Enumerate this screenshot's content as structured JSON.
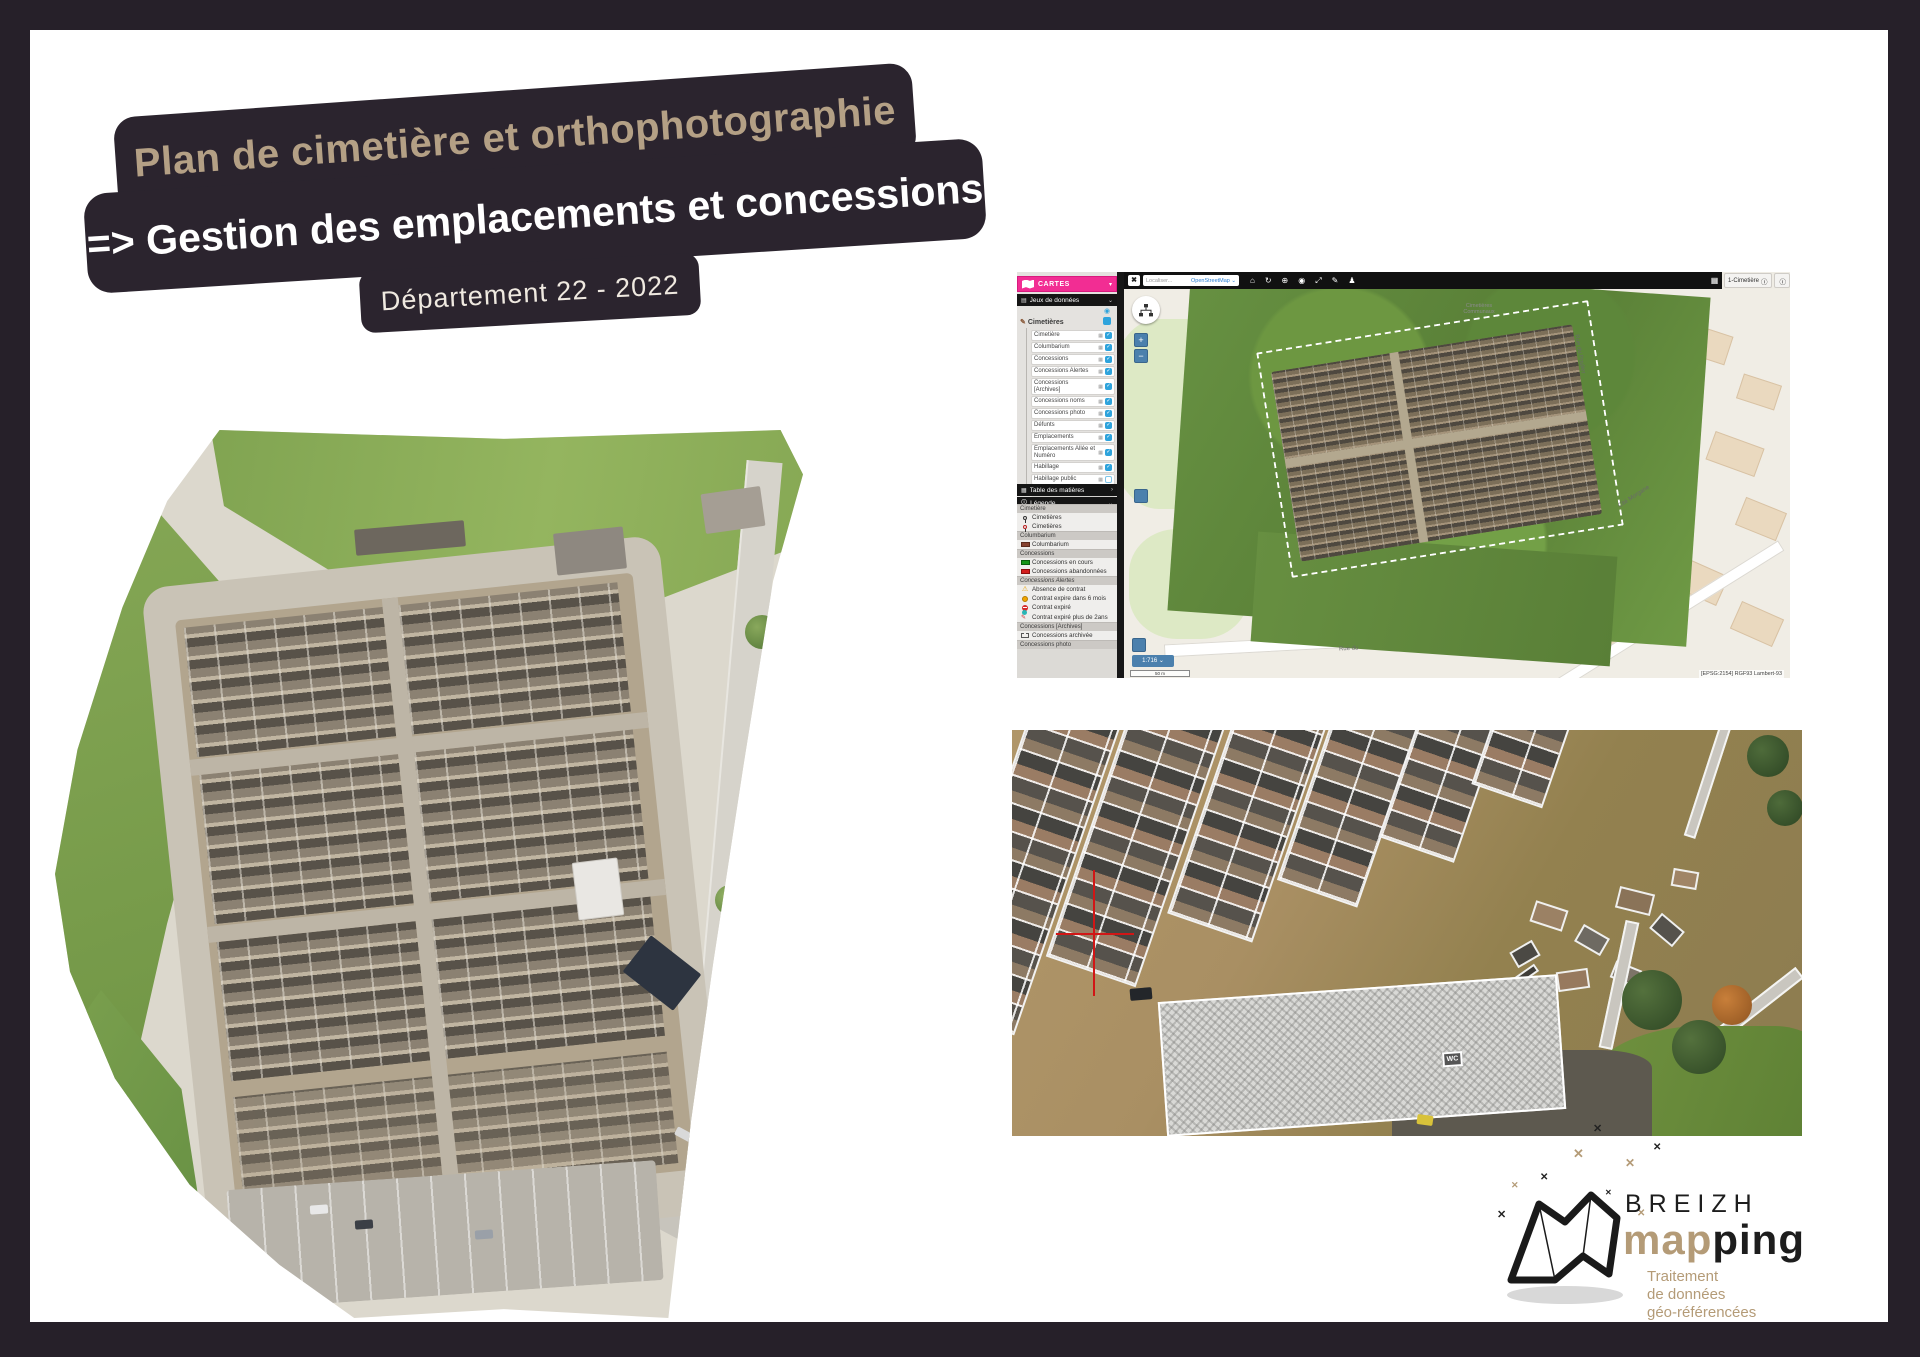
{
  "banner": {
    "line1": "Plan de cimetière et orthophotographie",
    "line2": "=> Gestion des emplacements et concessions",
    "line3": "Département 22 - 2022"
  },
  "gis": {
    "panel_title": "CARTES",
    "datasets_bar": "Jeux de données",
    "group": "Cimetières",
    "layers": [
      {
        "label": "Cimetière",
        "checked": true
      },
      {
        "label": "Columbarium",
        "checked": true
      },
      {
        "label": "Concessions",
        "checked": true
      },
      {
        "label": "Concessions Alertes",
        "checked": true
      },
      {
        "label": "Concessions [Archives]",
        "checked": true
      },
      {
        "label": "Concessions noms",
        "checked": true
      },
      {
        "label": "Concessions photo",
        "checked": true
      },
      {
        "label": "Défunts",
        "checked": true
      },
      {
        "label": "Emplacements",
        "checked": true
      },
      {
        "label": "Emplacements Allée et Numéro",
        "checked": true
      },
      {
        "label": "Habillage",
        "checked": true
      },
      {
        "label": "Habillage public",
        "checked": false
      },
      {
        "label": "Vue aérienne - Drone",
        "checked": true
      }
    ],
    "toc_bar": "Table des matières",
    "legend_bar": "Légende",
    "legend": [
      {
        "section": "Cimetière",
        "italic": false,
        "items": [
          {
            "icon": "pin-dark",
            "label": "Cimetières"
          },
          {
            "icon": "pin-red",
            "label": "Cimetières"
          }
        ]
      },
      {
        "section": "Columbarium",
        "italic": false,
        "items": [
          {
            "icon": "swatch-maroon",
            "label": "Columbarium"
          }
        ]
      },
      {
        "section": "Concessions",
        "italic": false,
        "items": [
          {
            "icon": "swatch-green",
            "label": "Concessions en cours"
          },
          {
            "icon": "swatch-red",
            "label": "Concessions abandonnées"
          }
        ]
      },
      {
        "section": "Concessions Alertes",
        "italic": true,
        "items": [
          {
            "icon": "warning-triangle",
            "label": "Absence de contrat"
          },
          {
            "icon": "orange-circle",
            "label": "Contrat expire dans 6 mois"
          },
          {
            "icon": "stop-sign",
            "label": "Contrat expiré"
          },
          {
            "icon": "teal-pen",
            "label": "Contrat expiré plus de 2ans"
          }
        ]
      },
      {
        "section": "Concessions [Archives]",
        "italic": false,
        "items": [
          {
            "icon": "archive-box",
            "label": "Concessions archivée"
          }
        ]
      },
      {
        "section": "Concessions photo",
        "italic": false,
        "items": []
      }
    ],
    "toolbar": {
      "close": "✖",
      "search_placeholder": "Localiser...",
      "basemap": "OpenStreetMap ⌄",
      "chip_title": "1-Cimetière",
      "chip_info": "ⓘ"
    },
    "map": {
      "scale_chip": "1:716 ⌄",
      "scalebar": "50 m",
      "crs": "[EPSG:2154] RGF93 Lambert-93",
      "label_line1": "Cimetières",
      "label_line2": "Communaux",
      "street1": "Rue du",
      "street2": "Cité Morgane",
      "street3": "Rue du Poulier",
      "zoom_in": "+",
      "zoom_out": "−"
    },
    "colors": {
      "accent_pink": "#f22d93",
      "checkbox_blue": "#2ea3dc",
      "button_blue": "#4b80ad",
      "legend_green": "#169416",
      "legend_red": "#d41e1e",
      "legend_maroon": "#86412f"
    }
  },
  "photo2": {
    "wc_label": "WC"
  },
  "logo": {
    "brand_top": "BREIZH",
    "brand_map": "map",
    "brand_ping": "ping",
    "tagline1": "Traitement",
    "tagline2": "de données",
    "tagline3": "géo-référencées"
  }
}
